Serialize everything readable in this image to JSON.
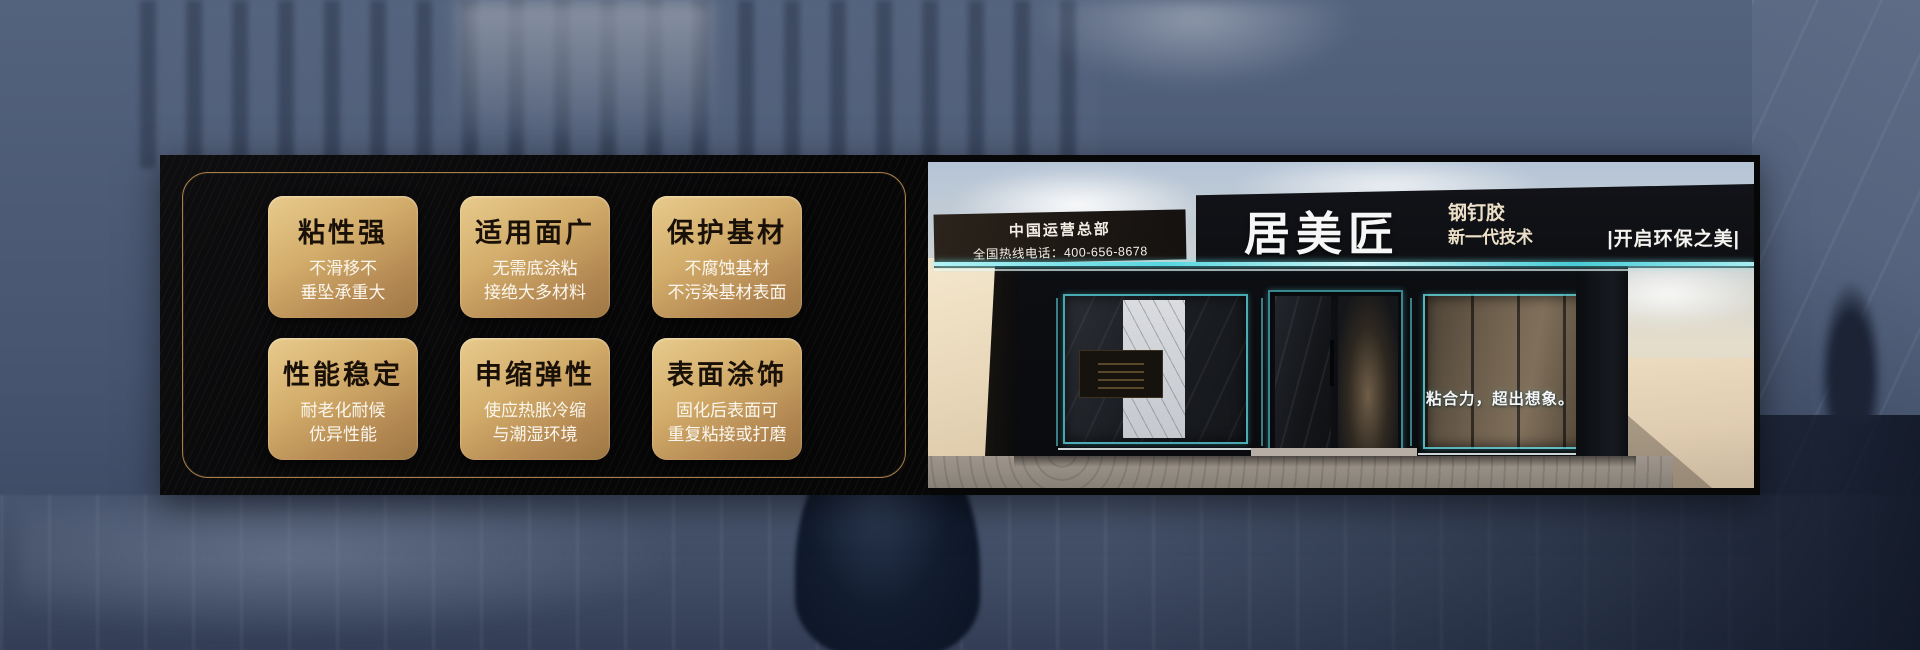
{
  "features": {
    "cards": [
      {
        "title": "粘性强",
        "line1": "不滑移不",
        "line2": "垂坠承重大"
      },
      {
        "title": "适用面广",
        "line1": "无需底涂粘",
        "line2": "接绝大多材料"
      },
      {
        "title": "保护基材",
        "line1": "不腐蚀基材",
        "line2": "不污染基材表面"
      },
      {
        "title": "性能稳定",
        "line1": "耐老化耐候",
        "line2": "优异性能"
      },
      {
        "title": "申缩弹性",
        "line1": "使应热胀冷缩",
        "line2": "与潮湿环境"
      },
      {
        "title": "表面涂饰",
        "line1": "固化后表面可",
        "line2": "重复粘接或打磨"
      }
    ]
  },
  "storefront": {
    "hq": "中国运营总部",
    "hotline": "全国热线电话：400-656-8678",
    "brand": "居美匠",
    "product": "钢钉胶",
    "generation": "新一代技术",
    "eco_slogan": "|开启环保之美|",
    "window_slogan": "粘合力，超出想象。"
  },
  "colors": {
    "card_gold_light": "#e8cb8e",
    "card_gold_dark": "#9c7743",
    "panel_border_gold": "#a97f49",
    "led_cyan": "#56d6df",
    "banner_black": "#070708",
    "background_blue": "#4c5a74"
  }
}
